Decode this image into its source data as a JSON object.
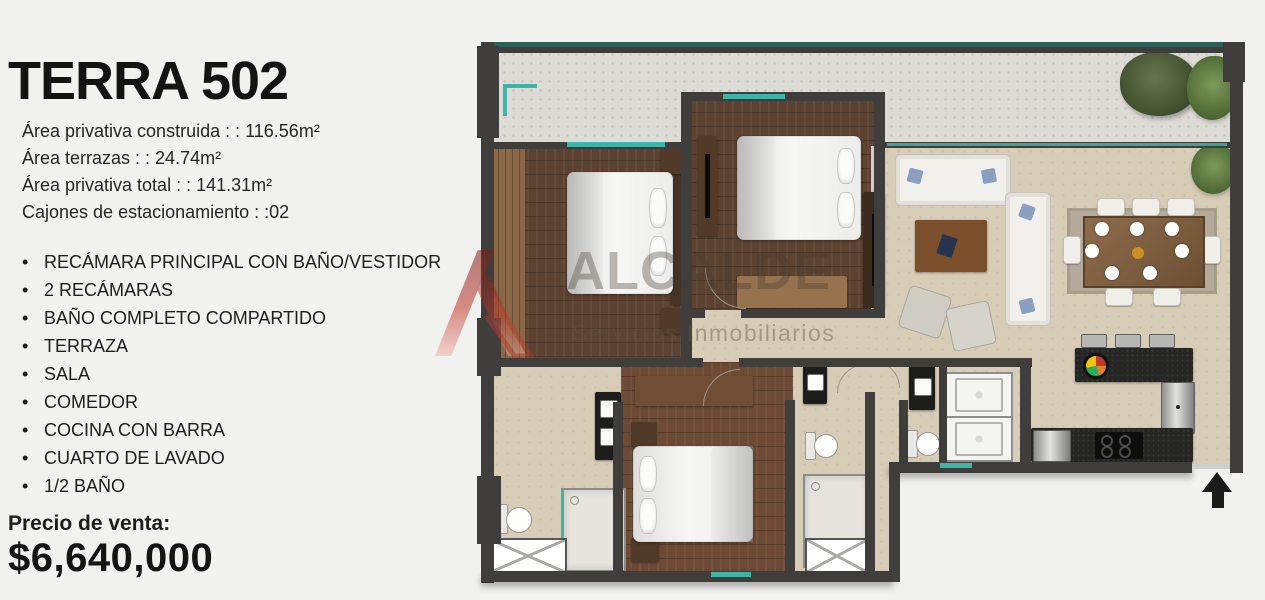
{
  "listing": {
    "title": "TERRA 502",
    "details": [
      "Área privativa construida : :  116.56m²",
      "Área terrazas  : :  24.74m²",
      "Área privativa total : : 141.31m²",
      "Cajones de estacionamiento : :02"
    ],
    "features": [
      "RECÁMARA PRINCIPAL CON BAÑO/VESTIDOR",
      "2 RECÁMARAS",
      "BAÑO COMPLETO COMPARTIDO",
      "TERRAZA",
      "SALA",
      "COMEDOR",
      "COCINA CON BARRA",
      "CUARTO DE LAVADO",
      "1/2 BAÑO"
    ],
    "price_label": "Precio de venta:",
    "price": "$6,640,000"
  },
  "watermark": {
    "brand": "ALCALDE",
    "tagline": "Servicios Inmobiliarios"
  },
  "floorplan": {
    "palette": {
      "wall": "#3f3e3c",
      "wood_dark": "#5c4230",
      "wood_master": "#6c4a35",
      "floor_beige": "#d7ccb6",
      "terrace_concrete": "#dcdbd5",
      "window_teal": "#3fb5a8",
      "counter_black": "#262624",
      "logo_red": "#c0392b"
    }
  }
}
